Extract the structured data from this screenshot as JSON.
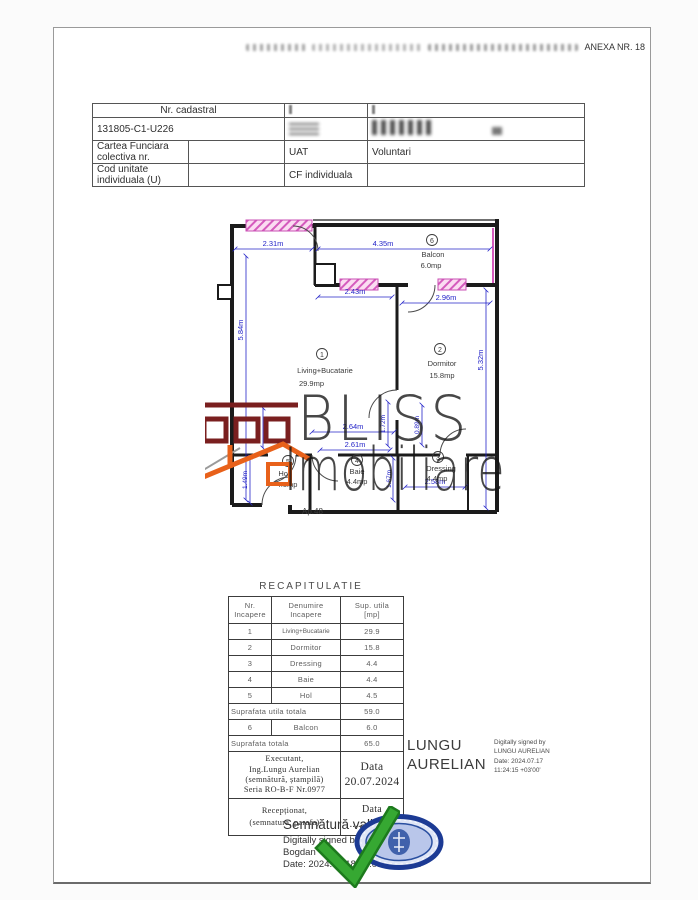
{
  "page": {
    "anexa_label": "ANEXA NR. 18"
  },
  "header_table": {
    "nr_cadastral_label": "Nr. cadastral",
    "nr_cadastral_value": "131805-C1-U226",
    "cartea_funciara_label": "Cartea Funciara colectiva nr.",
    "uat_label": "UAT",
    "uat_value": "Voluntari",
    "cod_unitate_label": "Cod unitate individuala (U)",
    "cf_individuala_label": "CF individuala"
  },
  "plan": {
    "apartment_label": "Ap.48",
    "rooms": {
      "living": {
        "num": "1",
        "name": "Living+Bucatarie",
        "area": "29.9mp"
      },
      "dormitor": {
        "num": "2",
        "name": "Dormitor",
        "area": "15.8mp"
      },
      "dressing": {
        "num": "3",
        "name": "Dressing",
        "area": "4.4mp"
      },
      "baie": {
        "num": "4",
        "name": "Baie",
        "area": "4.4mp"
      },
      "hol": {
        "num": "5",
        "name": "Hol",
        "area": "4.5mp"
      },
      "balcon": {
        "num": "6",
        "name": "Balcon",
        "area": "6.0mp"
      }
    },
    "dims": {
      "top_window": "2.31m",
      "balcon_width": "4.35m",
      "living_top": "2.43m",
      "dormitor_width": "2.96m",
      "living_height": "5.84m",
      "dormitor_height": "5.32m",
      "niche": "0.80m",
      "hol_height": "1.49m",
      "baie_top": "2.64m",
      "baie_width": "2.61m",
      "baie_upper": "1.72m",
      "baie_height": "1.67m",
      "dressing_upper": "0.89m",
      "dressing_width": "2.58m"
    },
    "colors": {
      "wall": "#1b1b1b",
      "dimension": "#2424c8",
      "window": "#d55bbd",
      "logo_maroon": "#7a1f1f",
      "logo_orange": "#e8611a"
    }
  },
  "watermark": {
    "line1": "BLISS",
    "line2": "Imobiliare"
  },
  "recap": {
    "title": "RECAPITULATIE",
    "headers": {
      "nr": "Nr.\nIncapere",
      "denumire": "Denumire\nIncapere",
      "sup": "Sup. utila\n[mp]"
    },
    "rows": [
      {
        "num": "1",
        "name": "Living+Bucatarie",
        "value": "29.9"
      },
      {
        "num": "2",
        "name": "Dormitor",
        "value": "15.8"
      },
      {
        "num": "3",
        "name": "Dressing",
        "value": "4.4"
      },
      {
        "num": "4",
        "name": "Baie",
        "value": "4.4"
      },
      {
        "num": "5",
        "name": "Hol",
        "value": "4.5"
      }
    ],
    "subtotal_label": "Suprafata utila totala",
    "subtotal_value": "59.0",
    "balcon_row": {
      "num": "6",
      "name": "Balcon",
      "value": "6.0"
    },
    "total_label": "Suprafata totala",
    "total_value": "65.0",
    "executant_text": "Executant,\nIng.Lungu Aurelian\n(semnătură, ștampilă)\nSeria RO-B-F Nr.0977",
    "executant_data": "Data\n20.07.2024",
    "receptionat_text": "Recepționat,\n(semnatura, parafa)",
    "receptionat_data": "Data\n................"
  },
  "signatures": {
    "lungu_name": "LUNGU\nAURELIAN",
    "lungu_details": "Digitally signed by\nLUNGU AURELIAN\nDate: 2024.07.17\n11:24:15 +03'00'",
    "valid_title": "Semnătură validă",
    "valid_body": "Digitally signed by Petre-Iulian\nBogdan\nDate: 2024.07.18 14:03:56 EEST"
  }
}
